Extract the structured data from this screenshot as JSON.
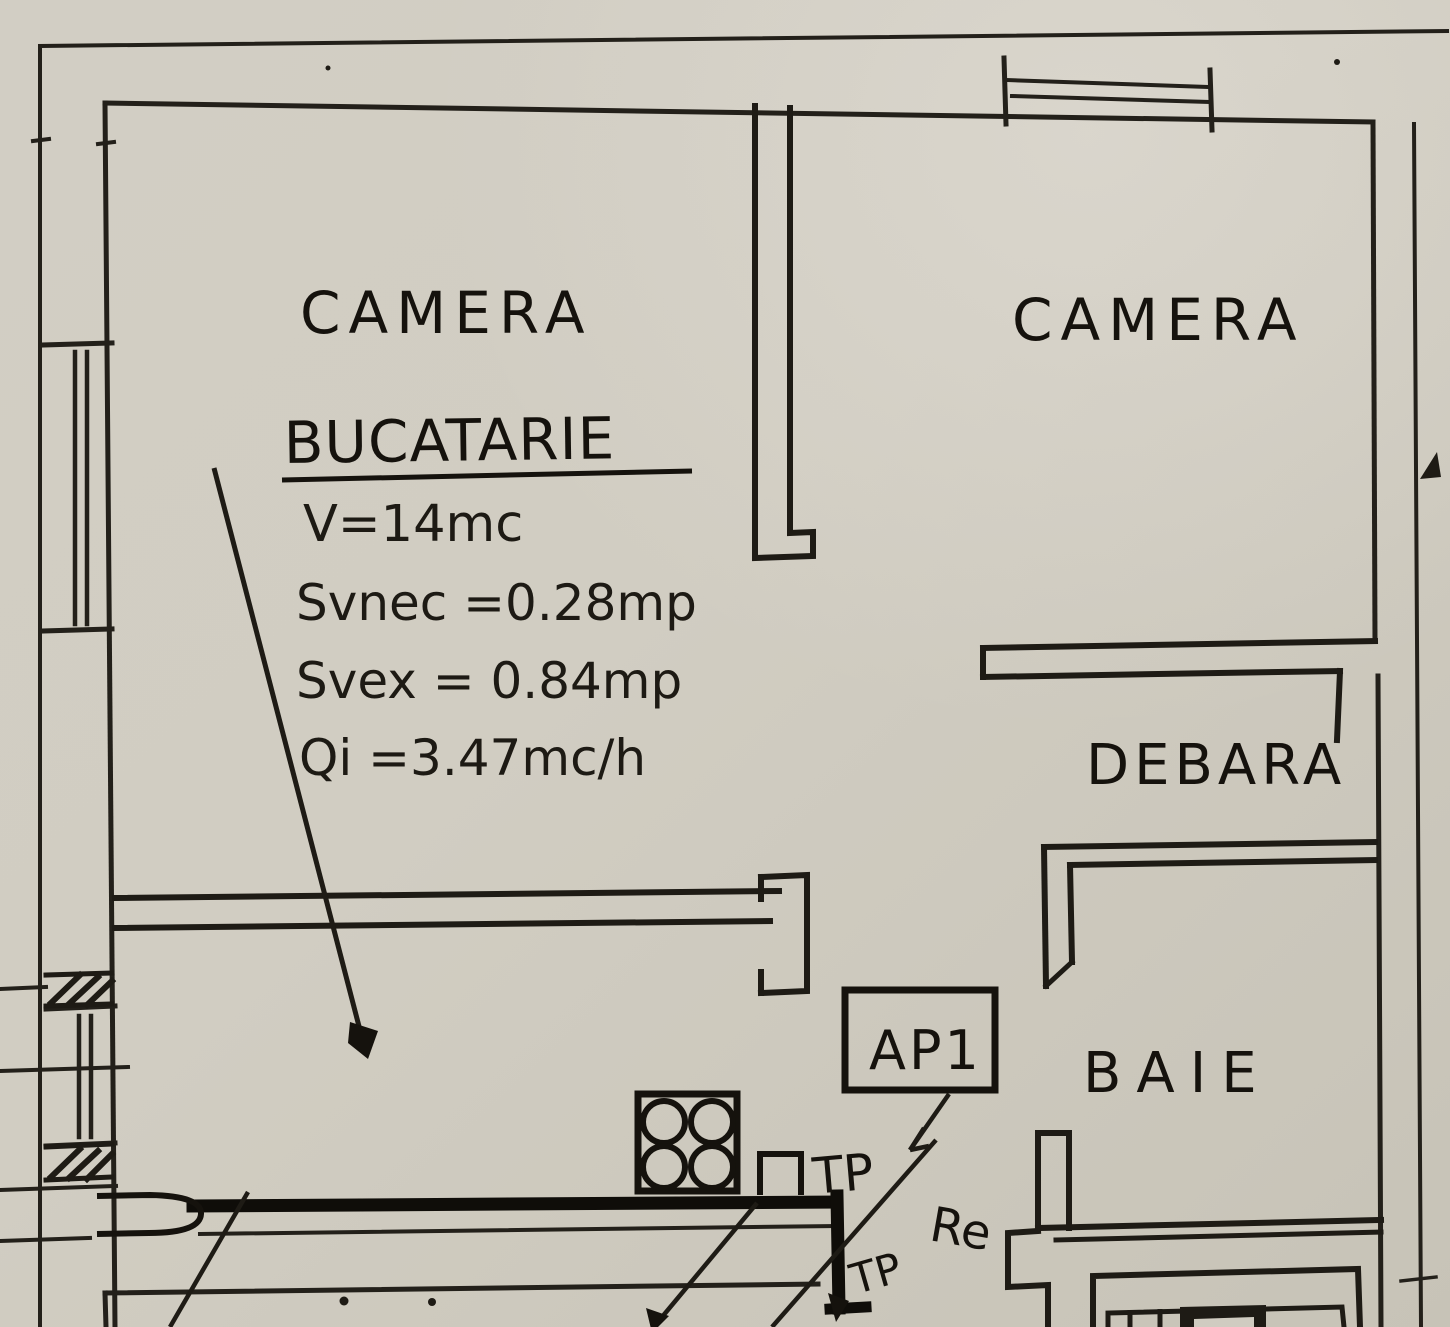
{
  "colors": {
    "paper_light": "#d8d4cb",
    "paper": "#d0ccc1",
    "paper_dark": "#c5c1b5",
    "ink": "#1e1b15"
  },
  "rooms": {
    "camera_left": "CAMERA",
    "camera_right": "CAMERA",
    "bucatarie": "BUCATARIE",
    "debara": "DEBARA",
    "baie": "BAIE"
  },
  "kitchen_specs": {
    "volume": "V=14mc",
    "surface_nec": "Svnec =0.28mp",
    "surface_ex": "Svex = 0.84mp",
    "flow": "Qi =3.47mc/h"
  },
  "annotations": {
    "apartment_tag": "AP1",
    "tp_upper": "TP",
    "re": "Re",
    "tp_lower": "TP"
  }
}
